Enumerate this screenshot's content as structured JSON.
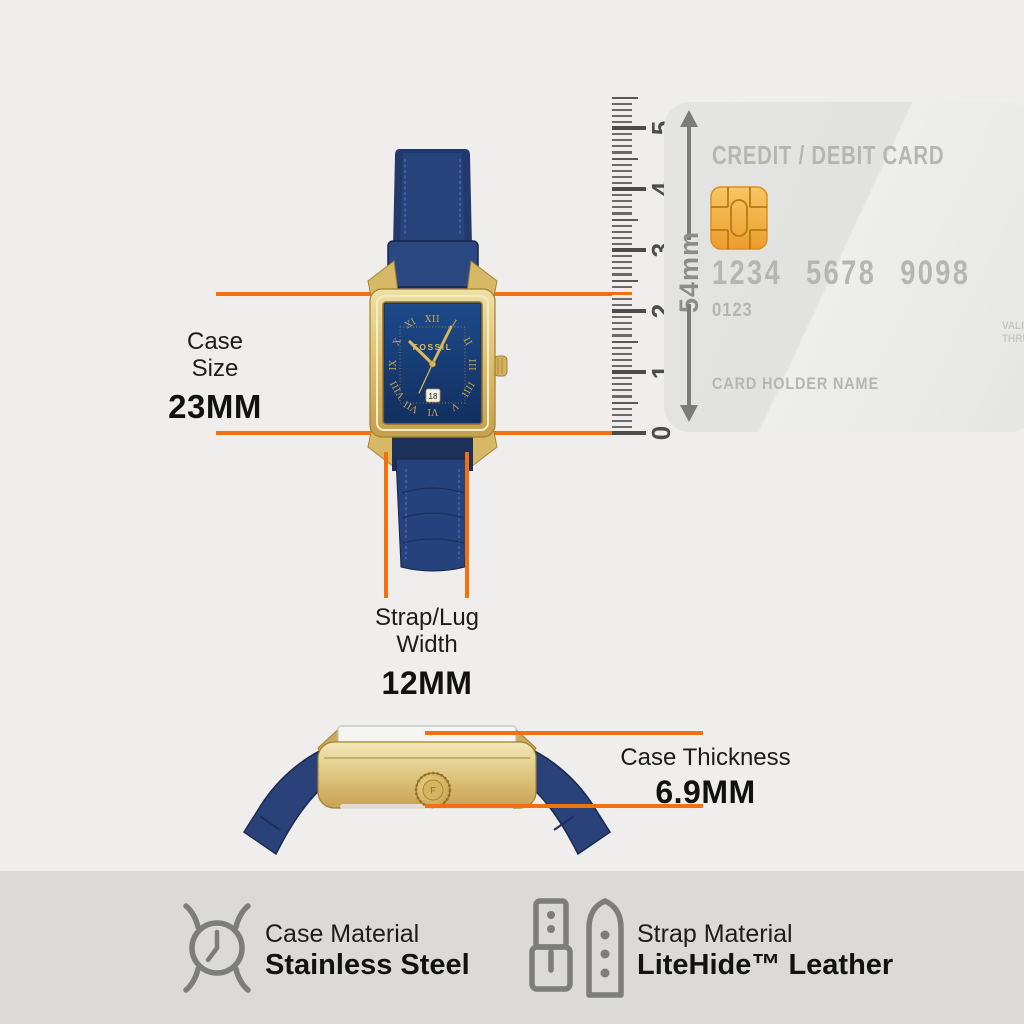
{
  "accent_color": "#f2700f",
  "case_size": {
    "label_line1": "Case",
    "label_line2": "Size",
    "value": "23MM"
  },
  "strap_width": {
    "label_line1": "Strap/Lug",
    "label_line2": "Width",
    "value": "12MM"
  },
  "case_thickness": {
    "label": "Case Thickness",
    "value": "6.9MM"
  },
  "ruler": {
    "numbers": [
      "0",
      "1",
      "2",
      "3",
      "4",
      "5"
    ],
    "unit_label": "54mm"
  },
  "card": {
    "title": "CREDIT / DEBIT CARD",
    "number_groups": [
      "1234",
      "5678",
      "9098"
    ],
    "sub_number": "0123",
    "valid_line1": "VALID",
    "valid_line2": "THRU",
    "holder": "CARD HOLDER NAME"
  },
  "watch": {
    "brand": "FOSSIL",
    "date": "18",
    "numerals": [
      "XII",
      "I",
      "II",
      "III",
      "IIII",
      "V",
      "VI",
      "VII",
      "VIII",
      "IX",
      "X",
      "XI"
    ]
  },
  "footer": {
    "case_material_label": "Case Material",
    "case_material_value": "Stainless Steel",
    "strap_material_label": "Strap Material",
    "strap_material_value": "LiteHide™ Leather"
  }
}
